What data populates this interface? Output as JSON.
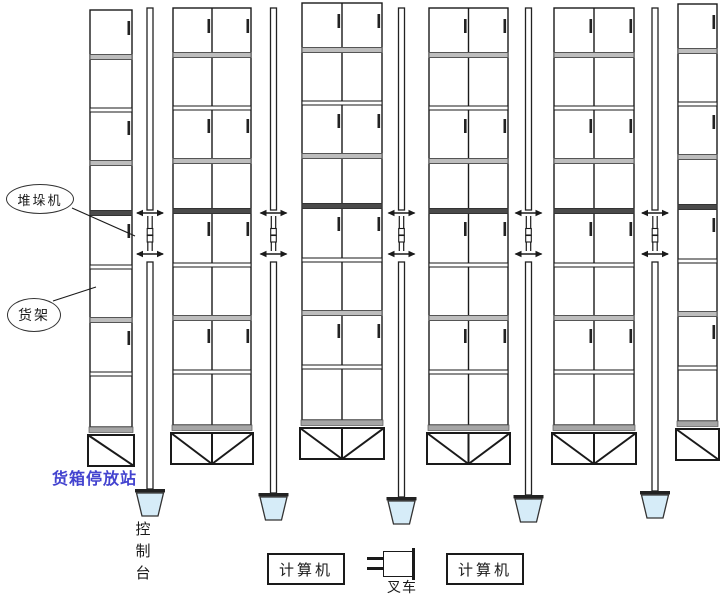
{
  "diagram": {
    "type": "automated-warehouse-layout",
    "labels": {
      "stacker_crane": "堆垛机",
      "rack": "货架",
      "container_station": "货箱停放站",
      "console": "控制台",
      "computer_left": "计算机",
      "computer_right": "计算机",
      "forklift": "叉车"
    },
    "colors": {
      "line": "#1a1a1a",
      "rail_stroke": "#222222",
      "shelf_gray": "#bdbdbd",
      "shelf_dark": "#4a4a4a",
      "base_bar_gray": "#a6a6a6",
      "station_fill": "#d6ecf8",
      "station_label_text": "#4343cf"
    },
    "structure": {
      "rows_per_rack": 8,
      "racks": [
        {
          "columns": 1
        },
        {
          "columns": 2
        },
        {
          "columns": 2
        },
        {
          "columns": 2
        },
        {
          "columns": 2
        },
        {
          "columns": 1
        }
      ],
      "aisle_count": 5,
      "stacker_cranes_per_aisle": 1,
      "control_stations_per_aisle": 1
    }
  }
}
